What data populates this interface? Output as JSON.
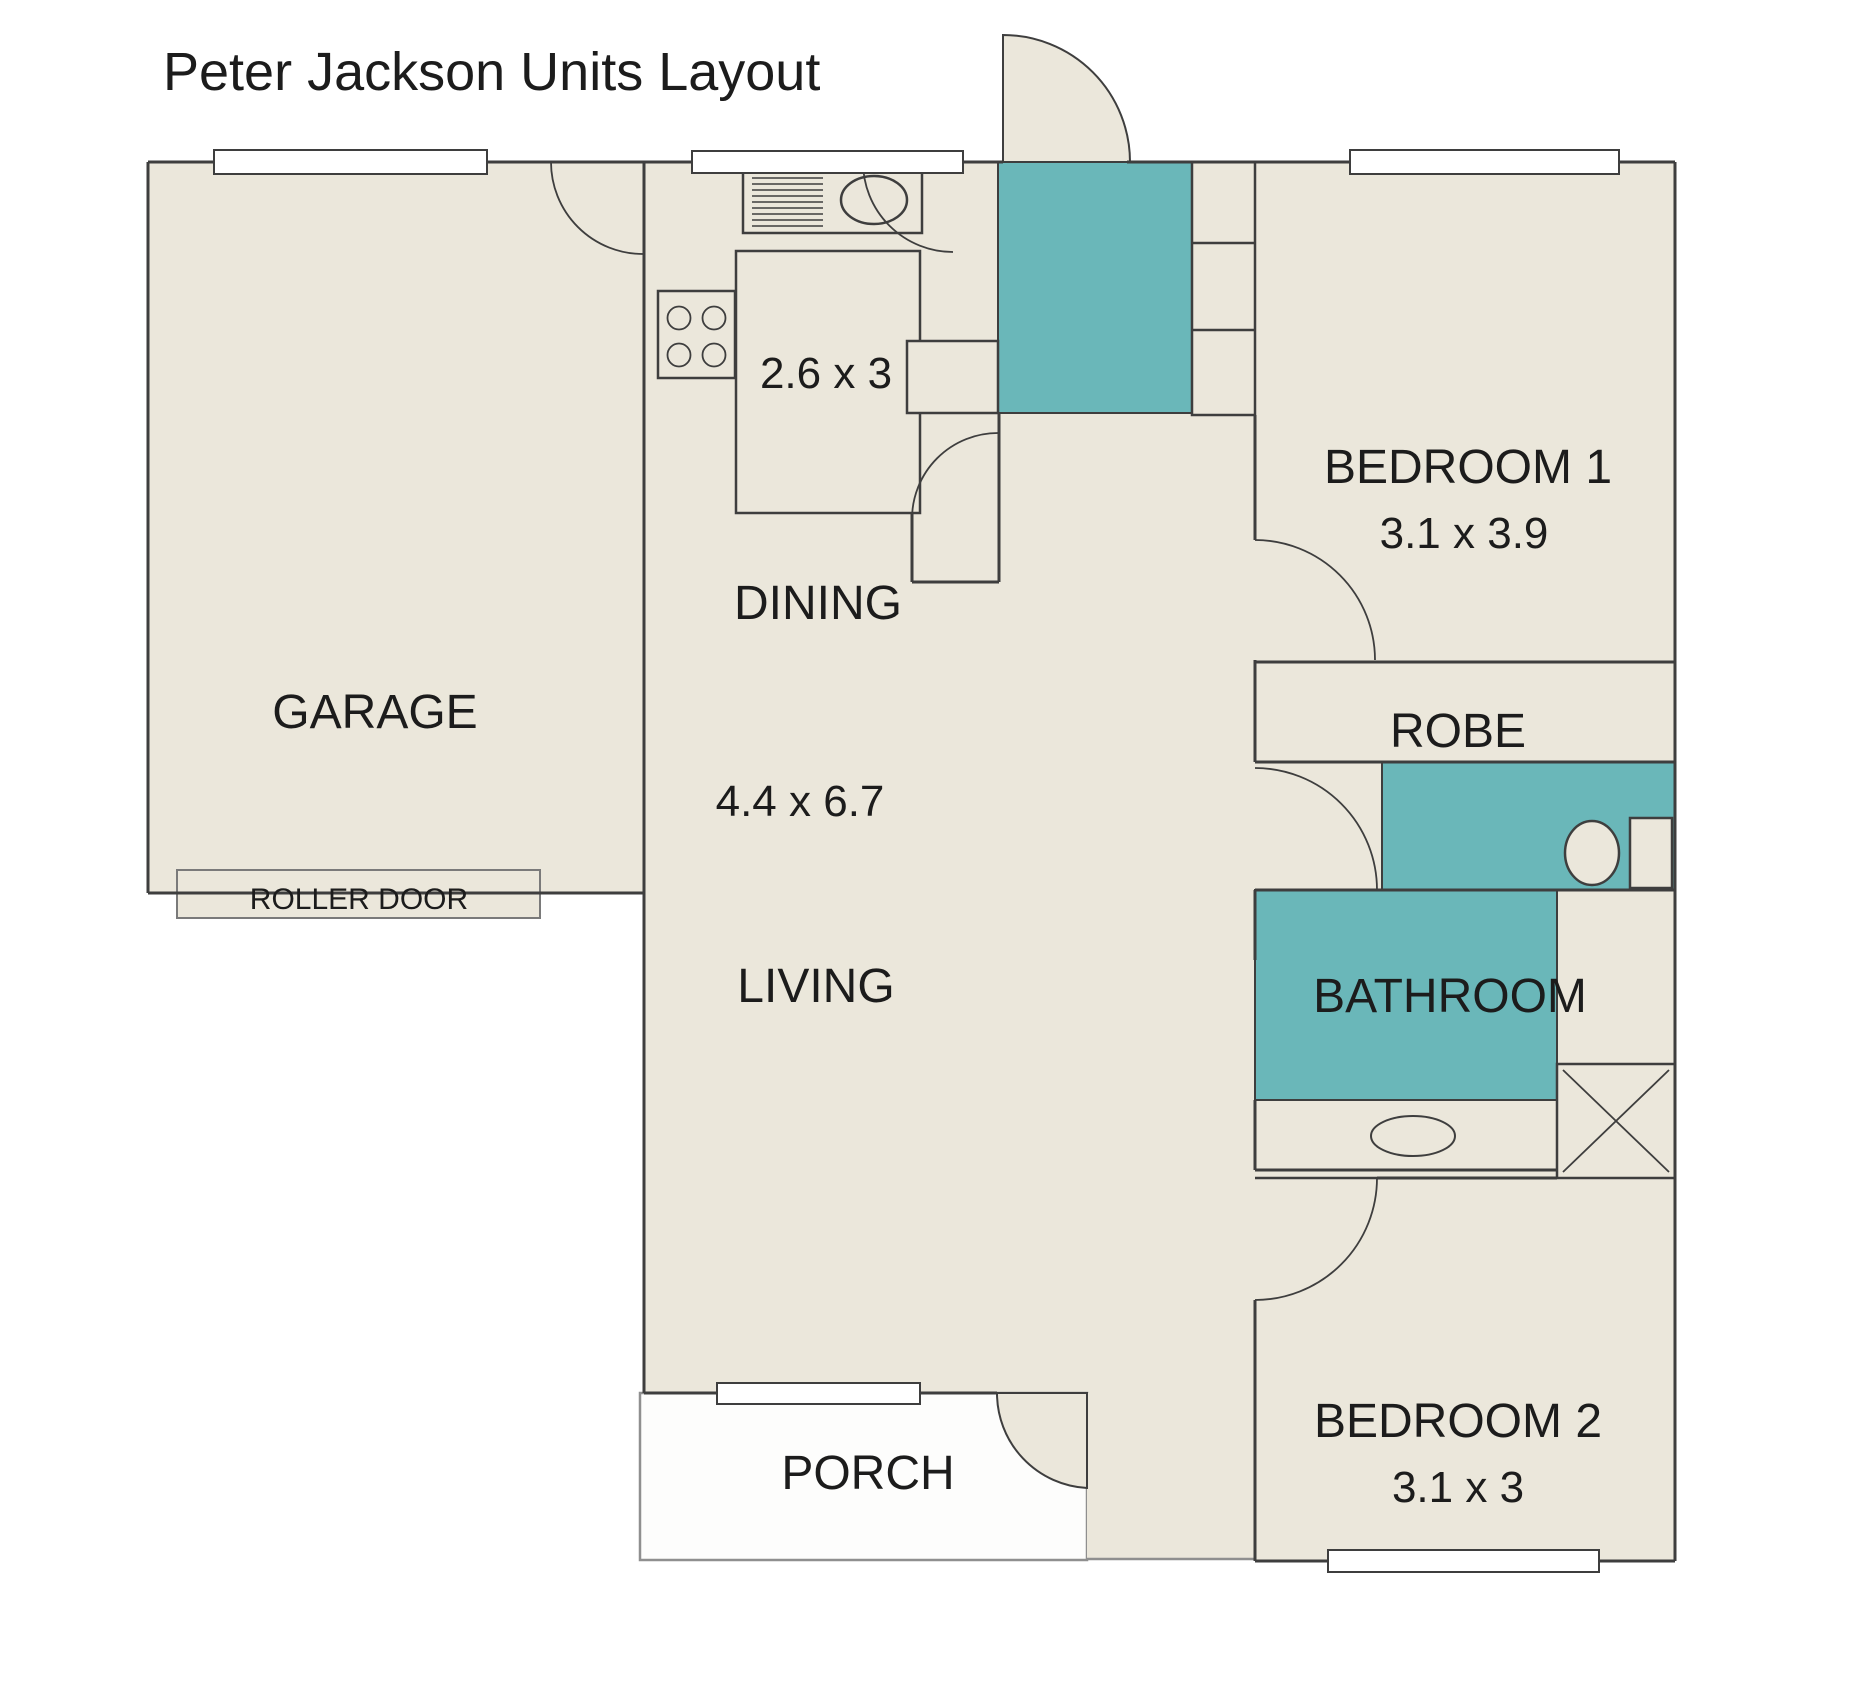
{
  "title": "Peter Jackson Units Layout",
  "colors": {
    "floor_fill": "#EBE7DB",
    "accent_teal": "#6AB7B9",
    "wall_line": "#3E3E3E",
    "porch_border": "#8F8F8F",
    "text": "#1C1C1C"
  },
  "rooms": {
    "garage": {
      "label": "GARAGE"
    },
    "roller_door": {
      "label": "ROLLER DOOR"
    },
    "kitchen": {
      "dimensions": "2.6 x 3"
    },
    "dining": {
      "label": "DINING",
      "dimensions": "4.4 x 6.7"
    },
    "living": {
      "label": "LIVING"
    },
    "porch": {
      "label": "PORCH"
    },
    "bedroom1": {
      "label": "BEDROOM 1",
      "dimensions": "3.1 x 3.9"
    },
    "robe": {
      "label": "ROBE"
    },
    "bathroom": {
      "label": "BATHROOM"
    },
    "bedroom2": {
      "label": "BEDROOM 2",
      "dimensions": "3.1 x 3"
    }
  }
}
